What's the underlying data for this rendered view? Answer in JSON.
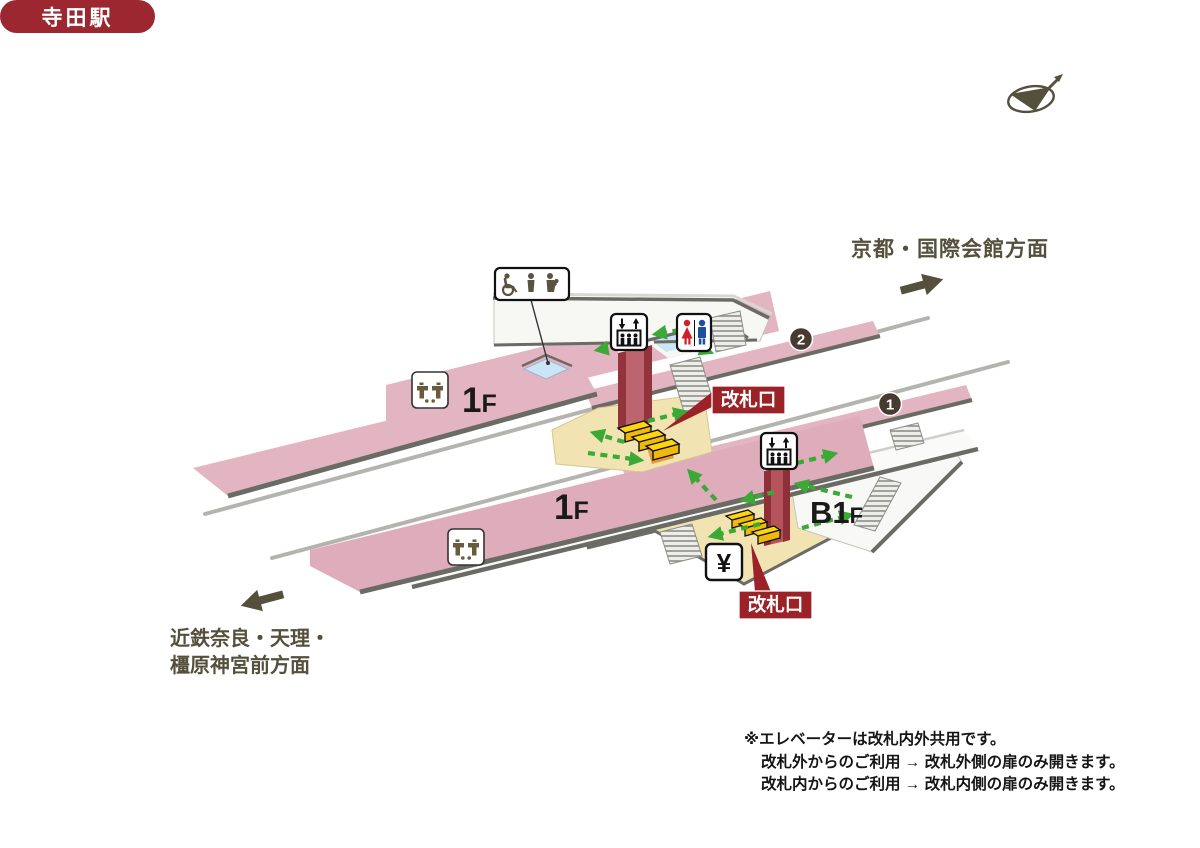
{
  "station": {
    "name": "寺田駅"
  },
  "directions": {
    "northeast": {
      "label": "京都・国際会館方面"
    },
    "southwest": {
      "label_line1": "近鉄奈良・天理・",
      "label_line2": "橿原神宮前方面"
    }
  },
  "floors": {
    "upper_platform": {
      "num": "1",
      "suffix": "F"
    },
    "lower_platform": {
      "num": "1",
      "suffix": "F"
    },
    "basement": {
      "num": "B1",
      "suffix": "F"
    }
  },
  "tracks": {
    "track1": "1",
    "track2": "2"
  },
  "gates": {
    "upper": "改札口",
    "lower": "改札口"
  },
  "facilities": {
    "ticket_machine": "¥",
    "icons": [
      "accessible-facilities-icon",
      "elevator-icon",
      "restroom-icon",
      "water-fountain-icon",
      "ticket-machine-icon",
      "compass-icon"
    ]
  },
  "notes": {
    "line1": "※エレベーターは改札内外共用です。",
    "line2": "改札外からのご利用 → 改札外側の扉のみ開きます。",
    "line3": "改札内からのご利用 → 改札内側の扉のみ開きます。"
  },
  "colors": {
    "badge_red": "#9B2227",
    "station_badge_red": "#9C2730",
    "platform_pink": "#E3B4C1",
    "platform_pink_deep": "#DFACBC",
    "concourse_beige": "#F2E4B2",
    "route_green": "#3AA935",
    "stairs_orange": "#E8982E",
    "escalator_teal": "#5FB8AB",
    "water_blue": "#C9E5F6",
    "gate_yellow": "#FFD60A",
    "text_olive": "#55503C"
  }
}
